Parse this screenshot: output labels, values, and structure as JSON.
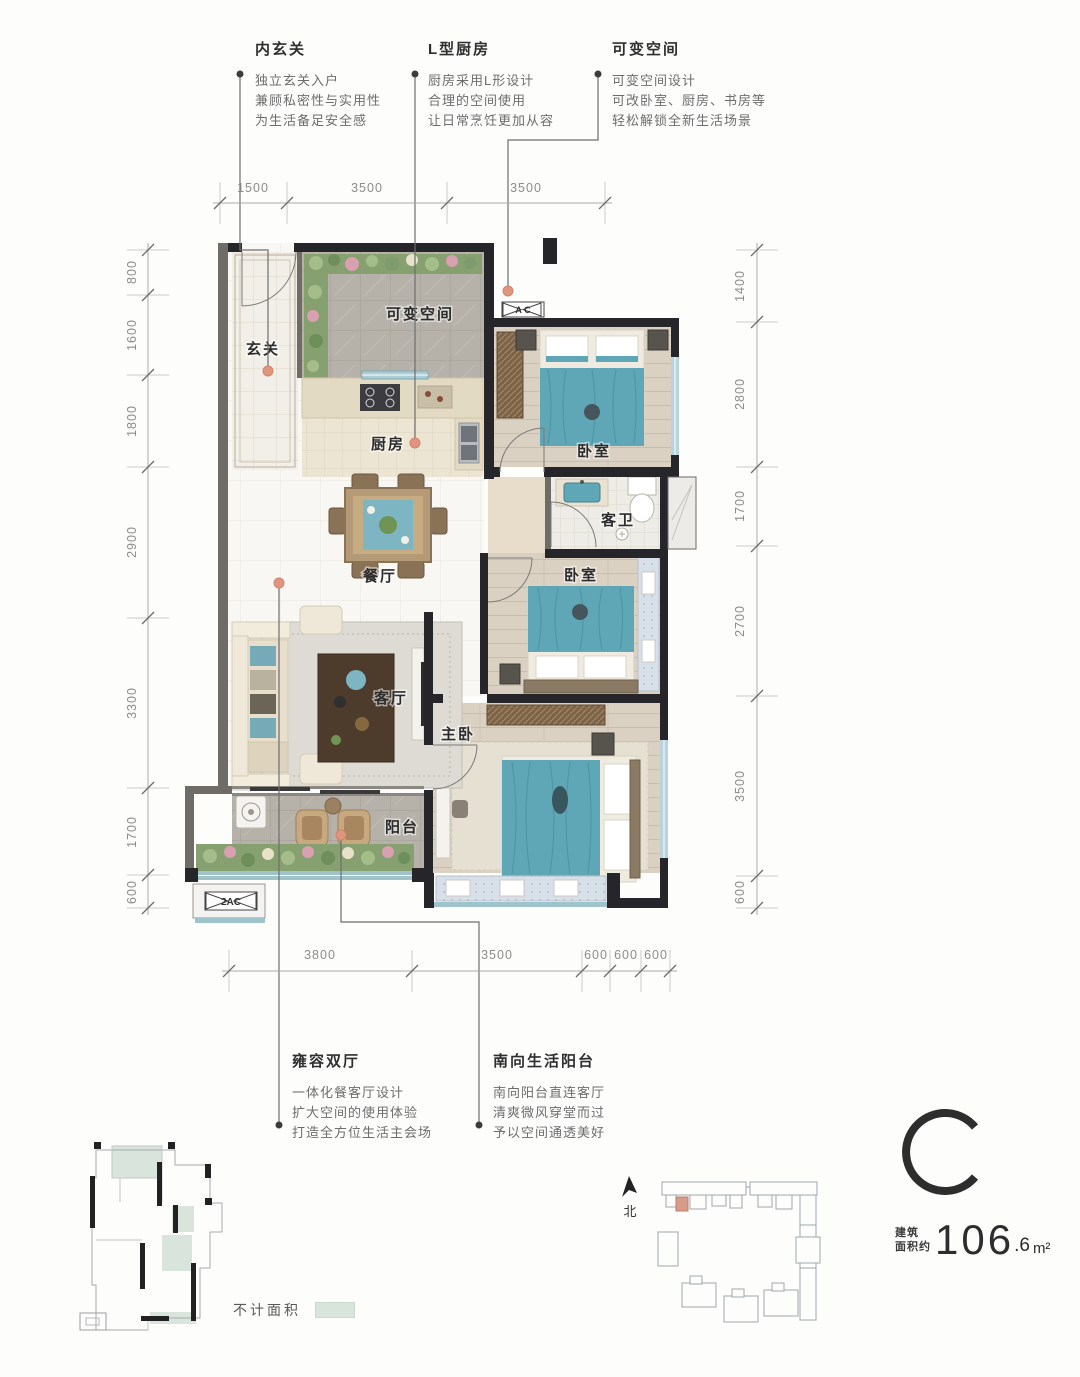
{
  "unit": {
    "letter": "C",
    "area_label_line1": "建筑",
    "area_label_line2": "面积约",
    "area_value": "106",
    "area_decimal": ".6",
    "area_unit": "m²",
    "north_label": "北",
    "legend_label": "不计面积"
  },
  "callouts_top": [
    {
      "title": "内玄关",
      "lines": [
        "独立玄关入户",
        "兼顾私密性与实用性",
        "为生活备足安全感"
      ]
    },
    {
      "title": "L型厨房",
      "lines": [
        "厨房采用L形设计",
        "合理的空间使用",
        "让日常烹饪更加从容"
      ]
    },
    {
      "title": "可变空间",
      "lines": [
        "可变空间设计",
        "可改卧室、厨房、书房等",
        "轻松解锁全新生活场景"
      ]
    }
  ],
  "callouts_bottom": [
    {
      "title": "雍容双厅",
      "lines": [
        "一体化餐客厅设计",
        "扩大空间的使用体验",
        "打造全方位生活主会场"
      ]
    },
    {
      "title": "南向生活阳台",
      "lines": [
        "南向阳台直连客厅",
        "清爽微风穿堂而过",
        "予以空间通透美好"
      ]
    }
  ],
  "rooms": [
    {
      "label": "玄关"
    },
    {
      "label": "可变空间"
    },
    {
      "label": "厨房"
    },
    {
      "label": "卧室"
    },
    {
      "label": "客卫"
    },
    {
      "label": "卧室"
    },
    {
      "label": "餐厅"
    },
    {
      "label": "客厅"
    },
    {
      "label": "主卧"
    },
    {
      "label": "阳台"
    }
  ],
  "plan_labels": {
    "ac_top": "A C",
    "ac_bottom": "2AC"
  },
  "dimensions": {
    "top": [
      "1500",
      "3500",
      "3500"
    ],
    "bottom": [
      "3800",
      "3500",
      "600",
      "600",
      "600"
    ],
    "left": [
      "800",
      "1600",
      "1800",
      "2900",
      "3300",
      "1700",
      "600"
    ],
    "right": [
      "1400",
      "2800",
      "1700",
      "2700",
      "3500",
      "600"
    ]
  },
  "colors": {
    "accent_dot": "#e0957f",
    "bed_teal": "#5fa6b6",
    "wall_dark": "#26262a",
    "greenery": "#87a070",
    "legend_green": "#d9e5dc",
    "site_highlight": "#d89a89"
  }
}
